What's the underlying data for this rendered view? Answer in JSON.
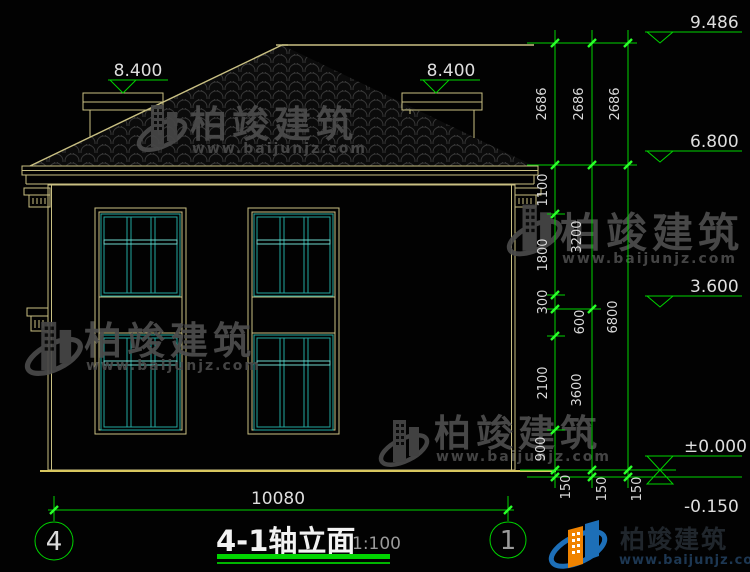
{
  "drawing": {
    "title": "4-1轴立面",
    "scale": "1:100",
    "axis_left": "4",
    "axis_right": "1",
    "width_dim": "10080"
  },
  "levels": {
    "ridge": "9.486",
    "eaves": "6.800",
    "floor2": "3.600",
    "ground": "±0.000",
    "below_ground": "-0.150",
    "parapet_left": "8.400",
    "parapet_right": "8.400"
  },
  "dims": {
    "chain_inner": [
      "2686",
      "1100",
      "1800",
      "300",
      "600",
      "2100",
      "900",
      "150"
    ],
    "chain_mid": [
      "2686",
      "3200",
      "3600",
      "150"
    ],
    "chain_outer": [
      "2686",
      "6800",
      "150"
    ]
  },
  "watermark": {
    "brand": "柏竣建筑",
    "url": "www.baijunjz.com"
  },
  "colors": {
    "dim_green": "#00d400",
    "tick_green": "#2aff2a",
    "line_tan": "#c9c083",
    "window_teal": "#22a8a0",
    "transom_teal": "#6fd6cc",
    "ground_yellow": "#d8c75f",
    "logo_blue": "#1d6fb8",
    "logo_orange": "#f08300"
  }
}
